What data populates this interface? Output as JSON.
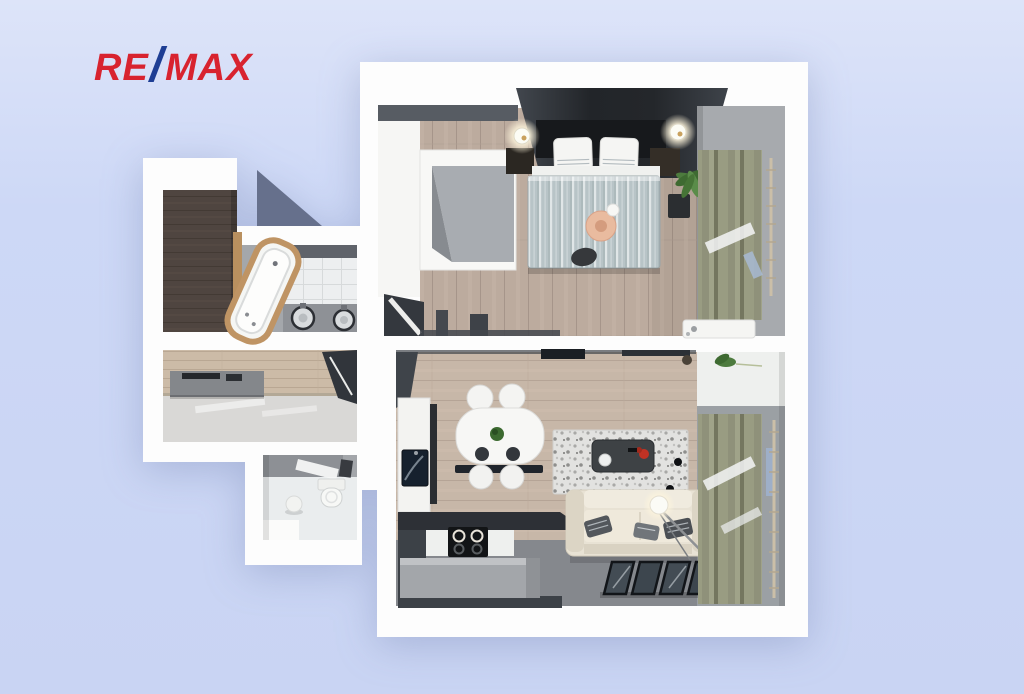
{
  "logo": {
    "re": "RE",
    "slash": "/",
    "max": "MAX"
  },
  "palette": {
    "background_top": "#dde4f9",
    "background_bottom": "#c9d4f3",
    "brand_red": "#d8232f",
    "brand_blue": "#1e3e94",
    "plan_wall_white": "#ffffff",
    "inner_wall_gray": "#5a6068",
    "bedroom_floor_wood": "#bcab9e",
    "living_floor_wood": "#c7b7a8",
    "living_floor_gray": "#85888d",
    "hall_floor_gray": "#d9d8d6",
    "bathroom_dark_wood": "#51463e",
    "tile_white": "#edeff0",
    "curtain_olive": "#8f917a",
    "duvet_blue_gray": "#b8c4c7",
    "sofa_cream": "#e8e2d4",
    "accent_peach": "#e9bb9f",
    "accent_red_decor": "#c03224",
    "plant_green": "#4d7b3e",
    "tub_wood_frame": "#bf9464"
  },
  "scene": {
    "description": "3D rendered top-down floor plan of a one-bedroom apartment",
    "rooms": [
      {
        "name": "bedroom",
        "items": [
          "double-bed",
          "striped-duvet",
          "pillows",
          "wall-lamps",
          "nightstands",
          "built-in-wardrobe",
          "potted-plant",
          "curtains",
          "window-bench",
          "peach-round-cushion"
        ]
      },
      {
        "name": "living-room-kitchen",
        "items": [
          "dining-table",
          "four-chairs",
          "bench",
          "kitchen-cabinet",
          "sink",
          "cooktop",
          "kitchen-island",
          "speckled-rug",
          "coffee-table",
          "cream-sofa",
          "throw-pillows",
          "arc-floor-lamp",
          "glass-panels",
          "curtains",
          "potted-plant"
        ]
      },
      {
        "name": "bathroom",
        "items": [
          "corner-bathtub",
          "double-sink-vanity",
          "mirror",
          "tiled-wall",
          "dark-wood-wall"
        ]
      },
      {
        "name": "hallway",
        "items": [
          "console-table",
          "wardrobe",
          "wood-panel-wall"
        ]
      },
      {
        "name": "wc",
        "items": [
          "toilet",
          "door"
        ]
      }
    ]
  }
}
